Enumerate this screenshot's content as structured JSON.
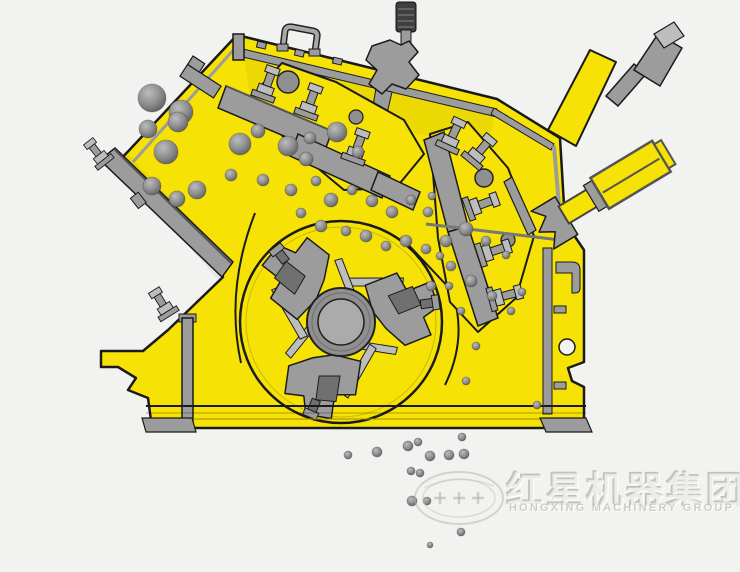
{
  "page": {
    "title": "Impact crusher cross-section diagram"
  },
  "colors": {
    "background": "#f2f2f0",
    "machine_yellow": "#f6e205",
    "yellow_shade": "#d8c500",
    "steel_gray": "#9c9c9c",
    "steel_light": "#bdbdbd",
    "steel_dark": "#707070",
    "outline": "#1a1a1a",
    "rock_light": "#bababa",
    "rock_mid": "#8e8e8e",
    "rock_dark": "#5e5e5e",
    "watermark_gray": "#c6c6bf"
  },
  "machine": {
    "type": "impact-crusher-cross-section",
    "parts": [
      "feed-chute",
      "upper-housing",
      "first-impact-apron",
      "second-impact-apron",
      "spring-tension-rod",
      "hydraulic-adjuster-cylinder",
      "rotor",
      "rotor-hub",
      "blow-bars",
      "frame",
      "base-skid",
      "discharge-opening"
    ]
  },
  "watermark": {
    "logo": "oval-emblem",
    "cn_text": "红星机器集团",
    "en_text": "HONGXING MACHINERY GROUP"
  },
  "particles": {
    "feed": [
      [
        152,
        98,
        14
      ],
      [
        181,
        112,
        12
      ],
      [
        148,
        129,
        9
      ],
      [
        166,
        152,
        12
      ],
      [
        178,
        122,
        10
      ],
      [
        152,
        186,
        9
      ],
      [
        177,
        199,
        8
      ],
      [
        197,
        190,
        9
      ],
      [
        231,
        175,
        6
      ],
      [
        240,
        144,
        11
      ],
      [
        258,
        131,
        7
      ],
      [
        288,
        146,
        10
      ],
      [
        310,
        138,
        6
      ],
      [
        337,
        132,
        10
      ],
      [
        306,
        159,
        7
      ],
      [
        358,
        152,
        6
      ]
    ],
    "chamber": [
      [
        263,
        180,
        6
      ],
      [
        291,
        190,
        6
      ],
      [
        316,
        181,
        5
      ],
      [
        331,
        200,
        7
      ],
      [
        352,
        190,
        5
      ],
      [
        372,
        201,
        6
      ],
      [
        392,
        212,
        6
      ],
      [
        411,
        200,
        5
      ],
      [
        428,
        212,
        5
      ],
      [
        301,
        213,
        5
      ],
      [
        321,
        226,
        6
      ],
      [
        346,
        231,
        5
      ],
      [
        366,
        236,
        6
      ],
      [
        386,
        246,
        5
      ],
      [
        406,
        241,
        6
      ],
      [
        426,
        249,
        5
      ],
      [
        446,
        241,
        6
      ],
      [
        466,
        229,
        7
      ],
      [
        486,
        241,
        5
      ],
      [
        451,
        266,
        5
      ],
      [
        471,
        281,
        6
      ],
      [
        431,
        286,
        5
      ],
      [
        492,
        296,
        5
      ],
      [
        511,
        311,
        4
      ],
      [
        461,
        311,
        4
      ],
      [
        476,
        346,
        4
      ],
      [
        466,
        381,
        4
      ],
      [
        432,
        196,
        4
      ],
      [
        440,
        256,
        4
      ],
      [
        449,
        286,
        4
      ],
      [
        506,
        255,
        4
      ],
      [
        522,
        292,
        4
      ],
      [
        537,
        405,
        4
      ]
    ],
    "discharge": [
      [
        348,
        455,
        4
      ],
      [
        377,
        452,
        5
      ],
      [
        408,
        446,
        5
      ],
      [
        418,
        442,
        4
      ],
      [
        430,
        456,
        5
      ],
      [
        449,
        455,
        5
      ],
      [
        464,
        454,
        5
      ],
      [
        462,
        437,
        4
      ],
      [
        411,
        471,
        4
      ],
      [
        420,
        473,
        4
      ],
      [
        412,
        501,
        5
      ],
      [
        427,
        501,
        4
      ],
      [
        461,
        532,
        4
      ],
      [
        430,
        545,
        3
      ]
    ]
  }
}
